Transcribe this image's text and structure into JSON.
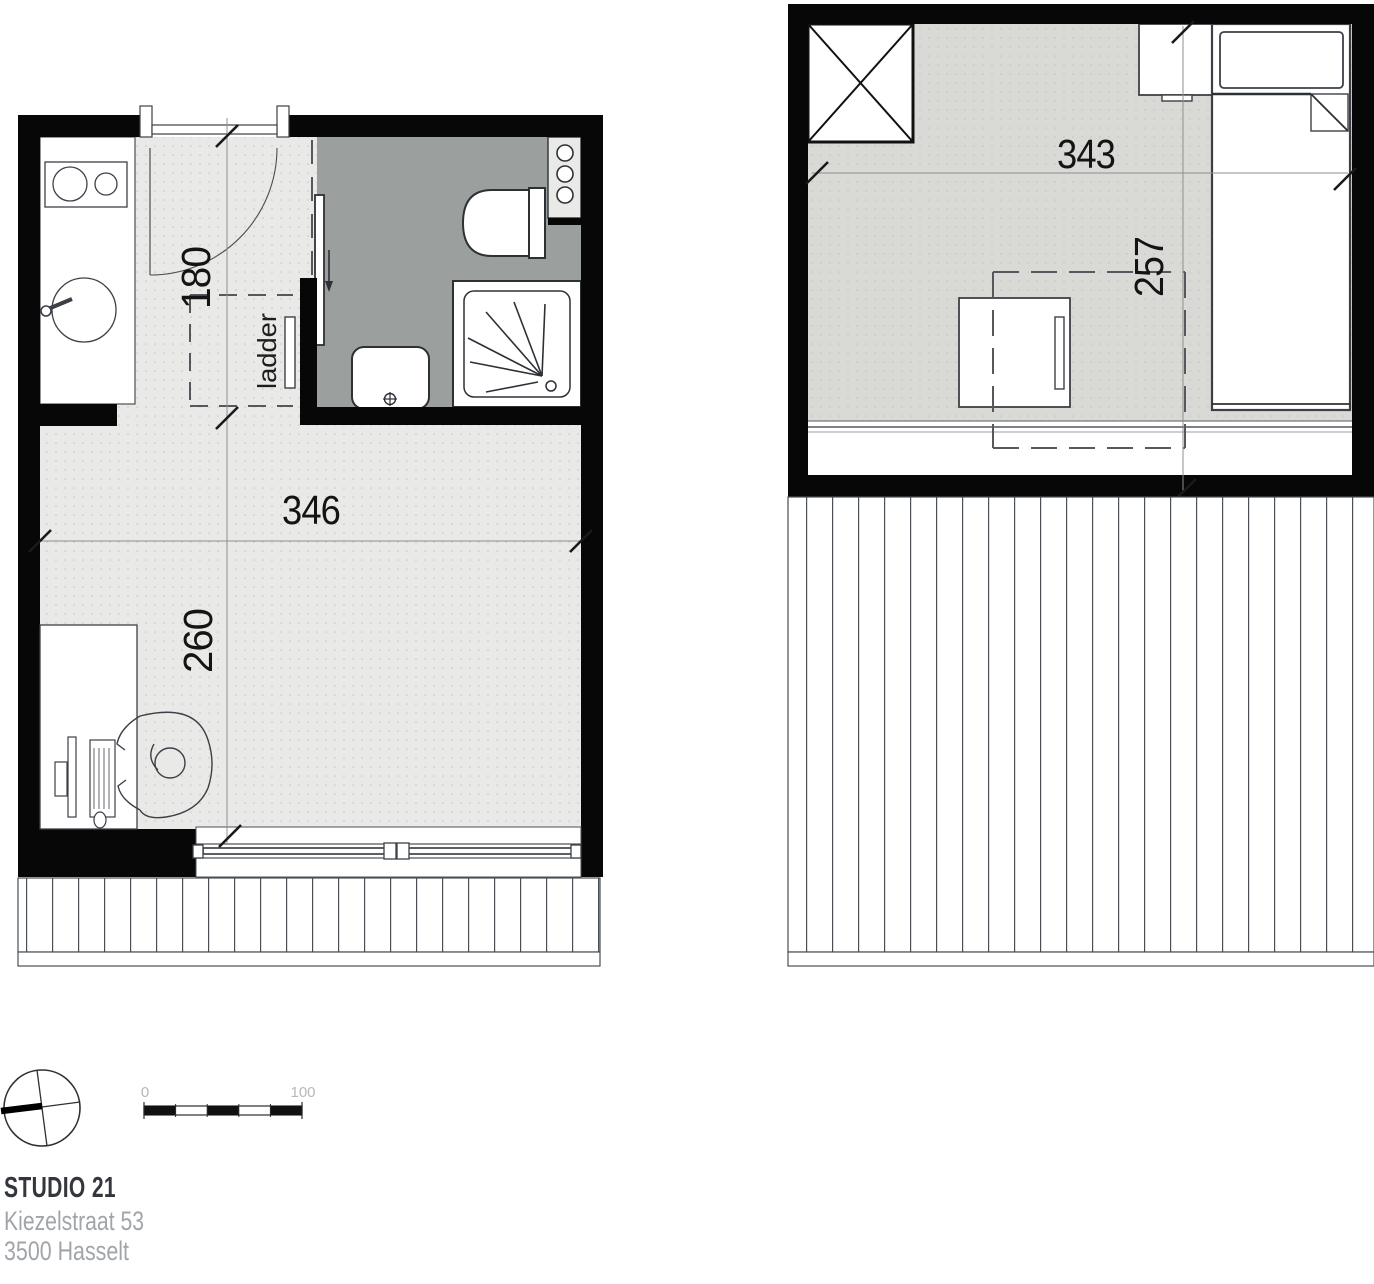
{
  "plan": {
    "ground_floor": {
      "dim_entry_depth": "180",
      "dim_width": "346",
      "dim_living_depth": "260",
      "ladder_label": "ladder"
    },
    "upper_floor": {
      "dim_width": "343",
      "dim_depth": "257"
    },
    "scale_bar": {
      "start": "0",
      "end": "100"
    },
    "title_block": {
      "project": "STUDIO 21",
      "address_line1": "Kiezelstraat 53",
      "address_line2": "3500 Hasselt"
    },
    "colors": {
      "wall": "#070707",
      "floor_ground": "#e9e9e7",
      "floor_upper": "#d9dad6",
      "floor_bathroom": "#9b9f9e",
      "dimension_text": "#141414",
      "muted_text": "#a1a5aa"
    }
  }
}
